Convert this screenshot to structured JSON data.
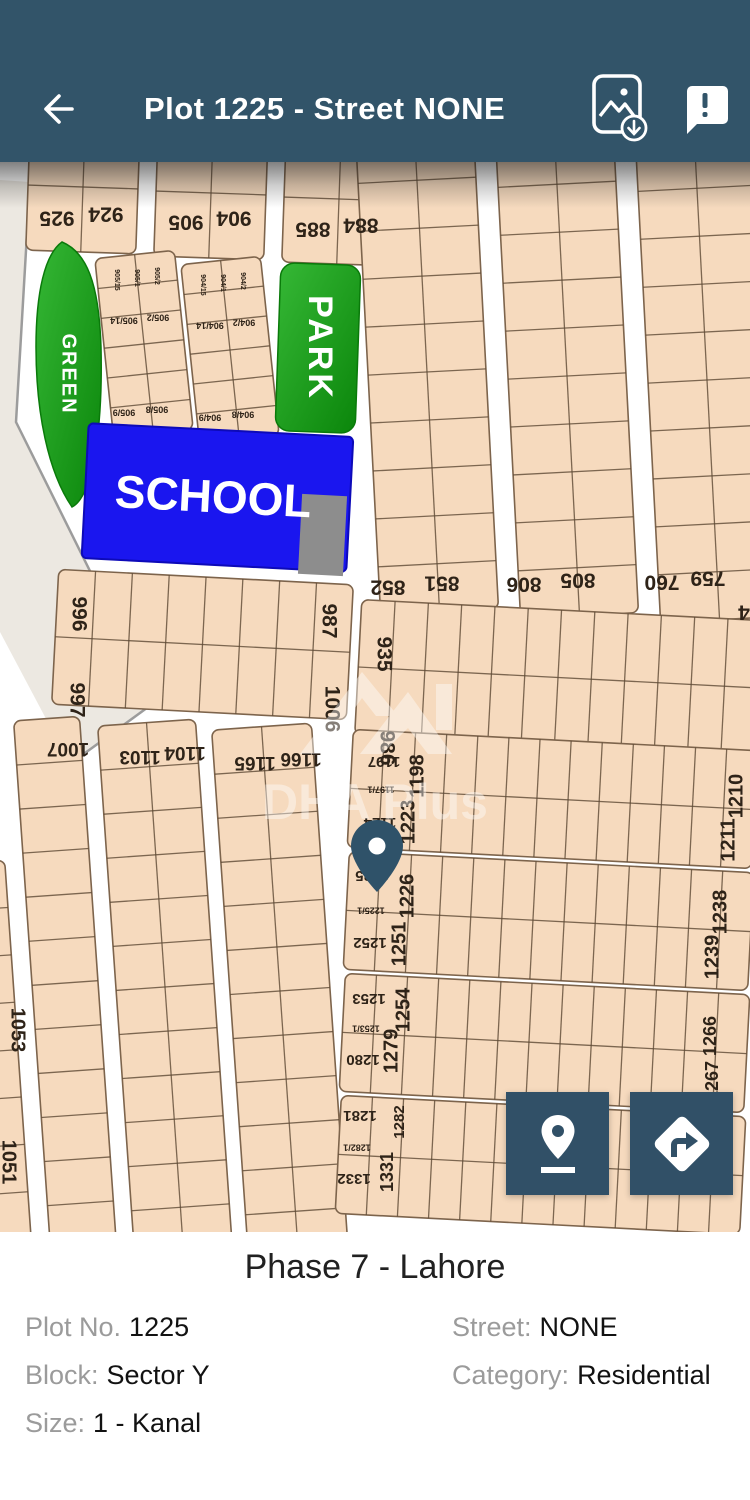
{
  "header": {
    "title": "Plot 1225 - Street NONE"
  },
  "map": {
    "green_label": "GREEN",
    "park_label": "PARK",
    "school_label": "SCHOOL",
    "watermark": "DHA Plus",
    "plot_labels": [
      {
        "t": "925",
        "x": 57,
        "y": 55,
        "r": 180,
        "s": 21
      },
      {
        "t": "924",
        "x": 106,
        "y": 51,
        "r": 180,
        "s": 21
      },
      {
        "t": "905",
        "x": 186,
        "y": 59,
        "r": 180,
        "s": 21
      },
      {
        "t": "904",
        "x": 234,
        "y": 55,
        "r": 180,
        "s": 21
      },
      {
        "t": "885",
        "x": 313,
        "y": 66,
        "r": 180,
        "s": 21
      },
      {
        "t": "884",
        "x": 361,
        "y": 62,
        "r": 180,
        "s": 21
      },
      {
        "t": "852",
        "x": 388,
        "y": 424,
        "r": 180,
        "s": 21
      },
      {
        "t": "851",
        "x": 442,
        "y": 420,
        "r": 180,
        "s": 21
      },
      {
        "t": "806",
        "x": 524,
        "y": 421,
        "r": 180,
        "s": 21
      },
      {
        "t": "805",
        "x": 578,
        "y": 417,
        "r": 180,
        "s": 21
      },
      {
        "t": "760",
        "x": 662,
        "y": 419,
        "r": 180,
        "s": 21
      },
      {
        "t": "759",
        "x": 708,
        "y": 415,
        "r": 180,
        "s": 21
      },
      {
        "t": "4",
        "x": 744,
        "y": 449,
        "r": 180,
        "s": 21
      },
      {
        "t": "905/14",
        "x": 124,
        "y": 158,
        "r": 180,
        "s": 9
      },
      {
        "t": "905/2",
        "x": 158,
        "y": 155,
        "r": 180,
        "s": 9
      },
      {
        "t": "905/9",
        "x": 124,
        "y": 250,
        "r": 180,
        "s": 9
      },
      {
        "t": "905/8",
        "x": 157,
        "y": 247,
        "r": 180,
        "s": 9
      },
      {
        "t": "905/15",
        "x": 117,
        "y": 118,
        "r": 90,
        "s": 7
      },
      {
        "t": "905/1",
        "x": 137,
        "y": 116,
        "r": 90,
        "s": 7
      },
      {
        "t": "905/2",
        "x": 157,
        "y": 114,
        "r": 90,
        "s": 7
      },
      {
        "t": "904/14",
        "x": 210,
        "y": 163,
        "r": 180,
        "s": 9
      },
      {
        "t": "904/2",
        "x": 244,
        "y": 160,
        "r": 180,
        "s": 9
      },
      {
        "t": "904/9",
        "x": 210,
        "y": 255,
        "r": 180,
        "s": 9
      },
      {
        "t": "904/8",
        "x": 243,
        "y": 252,
        "r": 180,
        "s": 9
      },
      {
        "t": "904/15",
        "x": 203,
        "y": 123,
        "r": 90,
        "s": 7
      },
      {
        "t": "904/1",
        "x": 223,
        "y": 121,
        "r": 90,
        "s": 7
      },
      {
        "t": "904/2",
        "x": 243,
        "y": 119,
        "r": 90,
        "s": 7
      },
      {
        "t": "996",
        "x": 78,
        "y": 452,
        "r": 90,
        "s": 21
      },
      {
        "t": "997",
        "x": 76,
        "y": 538,
        "r": 90,
        "s": 21
      },
      {
        "t": "987",
        "x": 328,
        "y": 459,
        "r": 90,
        "s": 21
      },
      {
        "t": "1006",
        "x": 331,
        "y": 547,
        "r": 90,
        "s": 21
      },
      {
        "t": "935",
        "x": 383,
        "y": 492,
        "r": 90,
        "s": 21
      },
      {
        "t": "986",
        "x": 386,
        "y": 586,
        "r": 90,
        "s": 21
      },
      {
        "t": "1007",
        "x": 68,
        "y": 586,
        "r": 180,
        "s": 19
      },
      {
        "t": "1103",
        "x": 140,
        "y": 594,
        "r": 180,
        "s": 19
      },
      {
        "t": "1104",
        "x": 185,
        "y": 590,
        "r": 180,
        "s": 19
      },
      {
        "t": "1165",
        "x": 255,
        "y": 600,
        "r": 180,
        "s": 19
      },
      {
        "t": "1166",
        "x": 301,
        "y": 596,
        "r": 180,
        "s": 19
      },
      {
        "t": "1053",
        "x": 17,
        "y": 868,
        "r": 90,
        "s": 20
      },
      {
        "t": "1051",
        "x": 8,
        "y": 1000,
        "r": 90,
        "s": 20
      },
      {
        "t": "1197",
        "x": 384,
        "y": 599,
        "r": 180,
        "s": 15
      },
      {
        "t": "1197/1",
        "x": 381,
        "y": 627,
        "r": 180,
        "s": 9
      },
      {
        "t": "1124",
        "x": 380,
        "y": 660,
        "r": 180,
        "s": 15
      },
      {
        "t": "1198",
        "x": 418,
        "y": 614,
        "r": -90,
        "s": 20
      },
      {
        "t": "1223",
        "x": 409,
        "y": 660,
        "r": -90,
        "s": 20
      },
      {
        "t": "1210",
        "x": 737,
        "y": 634,
        "r": -90,
        "s": 20
      },
      {
        "t": "1211",
        "x": 729,
        "y": 678,
        "r": -90,
        "s": 20
      },
      {
        "t": "1225",
        "x": 372,
        "y": 713,
        "r": 180,
        "s": 15
      },
      {
        "t": "1225/1",
        "x": 371,
        "y": 748,
        "r": 180,
        "s": 9
      },
      {
        "t": "1252",
        "x": 370,
        "y": 780,
        "r": 180,
        "s": 15
      },
      {
        "t": "1226",
        "x": 408,
        "y": 734,
        "r": -90,
        "s": 20
      },
      {
        "t": "1251",
        "x": 400,
        "y": 782,
        "r": -90,
        "s": 20
      },
      {
        "t": "1238",
        "x": 721,
        "y": 750,
        "r": -90,
        "s": 20
      },
      {
        "t": "1239",
        "x": 713,
        "y": 795,
        "r": -90,
        "s": 20
      },
      {
        "t": "1253",
        "x": 369,
        "y": 836,
        "r": 180,
        "s": 15
      },
      {
        "t": "1253/1",
        "x": 366,
        "y": 866,
        "r": 180,
        "s": 9
      },
      {
        "t": "1280",
        "x": 363,
        "y": 897,
        "r": 180,
        "s": 15
      },
      {
        "t": "1254",
        "x": 404,
        "y": 848,
        "r": -90,
        "s": 20
      },
      {
        "t": "1279",
        "x": 392,
        "y": 889,
        "r": -90,
        "s": 20
      },
      {
        "t": "1266",
        "x": 711,
        "y": 874,
        "r": -90,
        "s": 18
      },
      {
        "t": "1267",
        "x": 713,
        "y": 919,
        "r": -90,
        "s": 18
      },
      {
        "t": "1281",
        "x": 360,
        "y": 953,
        "r": 180,
        "s": 15
      },
      {
        "t": "1282/1",
        "x": 357,
        "y": 985,
        "r": 180,
        "s": 9
      },
      {
        "t": "1332",
        "x": 354,
        "y": 1016,
        "r": 180,
        "s": 15
      },
      {
        "t": "1331",
        "x": 388,
        "y": 1010,
        "r": -90,
        "s": 18
      },
      {
        "t": "1282",
        "x": 400,
        "y": 960,
        "r": -90,
        "s": 15
      }
    ]
  },
  "details": {
    "title": "Phase 7 - Lahore",
    "fields": [
      {
        "label": "Plot No.",
        "value": "1225"
      },
      {
        "label": "Street:",
        "value": "NONE"
      },
      {
        "label": "Block:",
        "value": "Sector Y"
      },
      {
        "label": "Category:",
        "value": "Residential"
      },
      {
        "label": "Size:",
        "value": "1 - Kanal"
      }
    ]
  }
}
